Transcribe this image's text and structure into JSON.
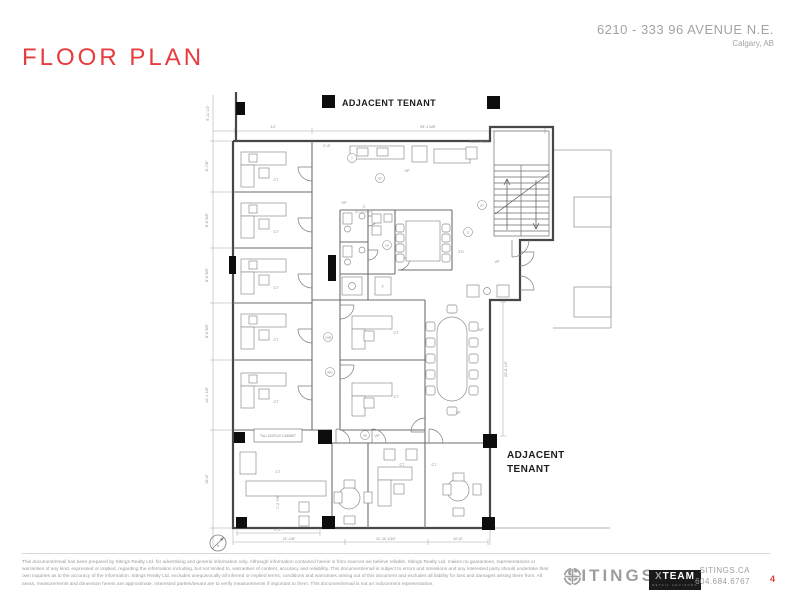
{
  "page": {
    "title": "FLOOR PLAN",
    "address_line1": "6210 - 333 96 AVENUE N.E.",
    "address_line2": "Calgary, AB",
    "page_number": "4"
  },
  "plan": {
    "adjacent_tenant_top": "ADJACENT TENANT",
    "adjacent_tenant_right_l1": "ADJACENT",
    "adjacent_tenant_right_l2": "TENANT",
    "elec_panel": "ELEC PANEL",
    "tall_display_cabinet": "TALL DISPLAY CABINET",
    "north_label": "N",
    "room_codes": {
      "ct": "CT",
      "vp": "VP",
      "wt": "WT",
      "st1": "ST1",
      "fridge": "F"
    },
    "keynotes": {
      "k1": "7",
      "k2": "A7",
      "k3": "1A",
      "k4": "5",
      "k5": "A7",
      "k6": "1AB",
      "k7": "AP1",
      "k8": "A6"
    },
    "dims": {
      "top_height": "9'-11 1/2\"",
      "top_a": "14'",
      "top_b": "93'-1 5/8\"",
      "top_c": "2'-6\"",
      "left_1": "8'-7/8\"",
      "left_2": "8'-5 5/8\"",
      "left_3": "8'-5 5/8\"",
      "left_4": "8'-5 5/8\"",
      "left_5": "12'-1 1/8\"",
      "left_6": "16'-6\"",
      "bottom_a": "9'-2\"",
      "bottom_b": "21'-1/8\"",
      "bottom_c": "11'-10 1/16\"",
      "bottom_d": "10'-8\"",
      "right_v": "22'-8 1/4\"",
      "conf": "2'",
      "desk": "7'-2 7/8\""
    }
  },
  "footer": {
    "disclaimer": "This document/email has been prepared by Sitings Realty Ltd. for advertising and general information only. Although information contained herein is from sources we believe reliable, Sitings Realty Ltd. makes no guarantees, representations or warranties of any kind, expressed or implied, regarding the information including, but not limited to, warranties of content, accuracy and reliability. This document/email is subject to errors and omissions and any interested party should undertake their own inquiries as to the accuracy of the information. Sitings Realty Ltd. excludes unequivocally all inferred or implied terms, conditions and warranties arising out of this document and excludes all liability for loss and damages arising there from. All areas, measurements and dimension herein are approximate. Interested parties/tenant are to verify measurements if important to them. This document/email is not an inducement representation.",
    "brand": "SITINGS",
    "xteam_name": "XTEAM",
    "xteam_tagline": "RETAIL ADVISORS",
    "website": "SITINGS.CA",
    "phone": "604.684.6767"
  },
  "colors": {
    "accent_red": "#e73b3d",
    "muted_gray": "#9e9e9e",
    "plan_line": "#6e6e6e"
  }
}
